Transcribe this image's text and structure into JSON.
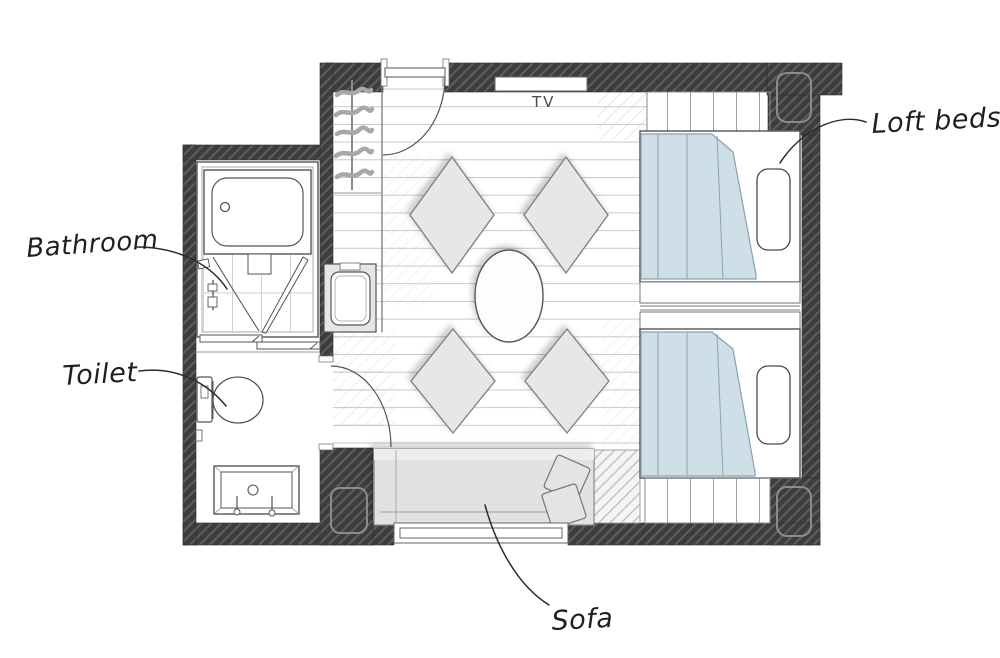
{
  "labels": {
    "bathroom": "Bathroom",
    "toilet": "Toilet",
    "loft_beds": "Loft beds",
    "sofa": "Sofa",
    "tv": "TV"
  },
  "colors": {
    "canvas": "#ffffff",
    "wall": "#3d3d3d",
    "wall_hatch": "#5e5e5e",
    "outline": "#555555",
    "floor_line": "#c8c8c8",
    "panel_line": "#9f9f9f",
    "cushion": "#e7e7e7",
    "cushion_border": "#7e7e7e",
    "sofa": "#e2e2e2",
    "blanket": "#cfdfe8",
    "blanket_line": "#8ba0b0",
    "ink": "#1f1f1f"
  },
  "fixtures": [
    "bathtub",
    "shower-washing-area",
    "bathroom-sliding-door",
    "bathroom-door",
    "toilet",
    "vanity-basin",
    "toilet-room-door",
    "wardrobe-hanger-rail",
    "coat-hangers",
    "mini-sink-unit",
    "balcony-door",
    "tv-board",
    "floor-cushions",
    "low-table",
    "sofa",
    "sofa-cushions",
    "window",
    "loft-bed-upper",
    "loft-bed-lower",
    "bed-head-platform",
    "bed-foot-platform",
    "bed-steps",
    "structural-columns"
  ]
}
